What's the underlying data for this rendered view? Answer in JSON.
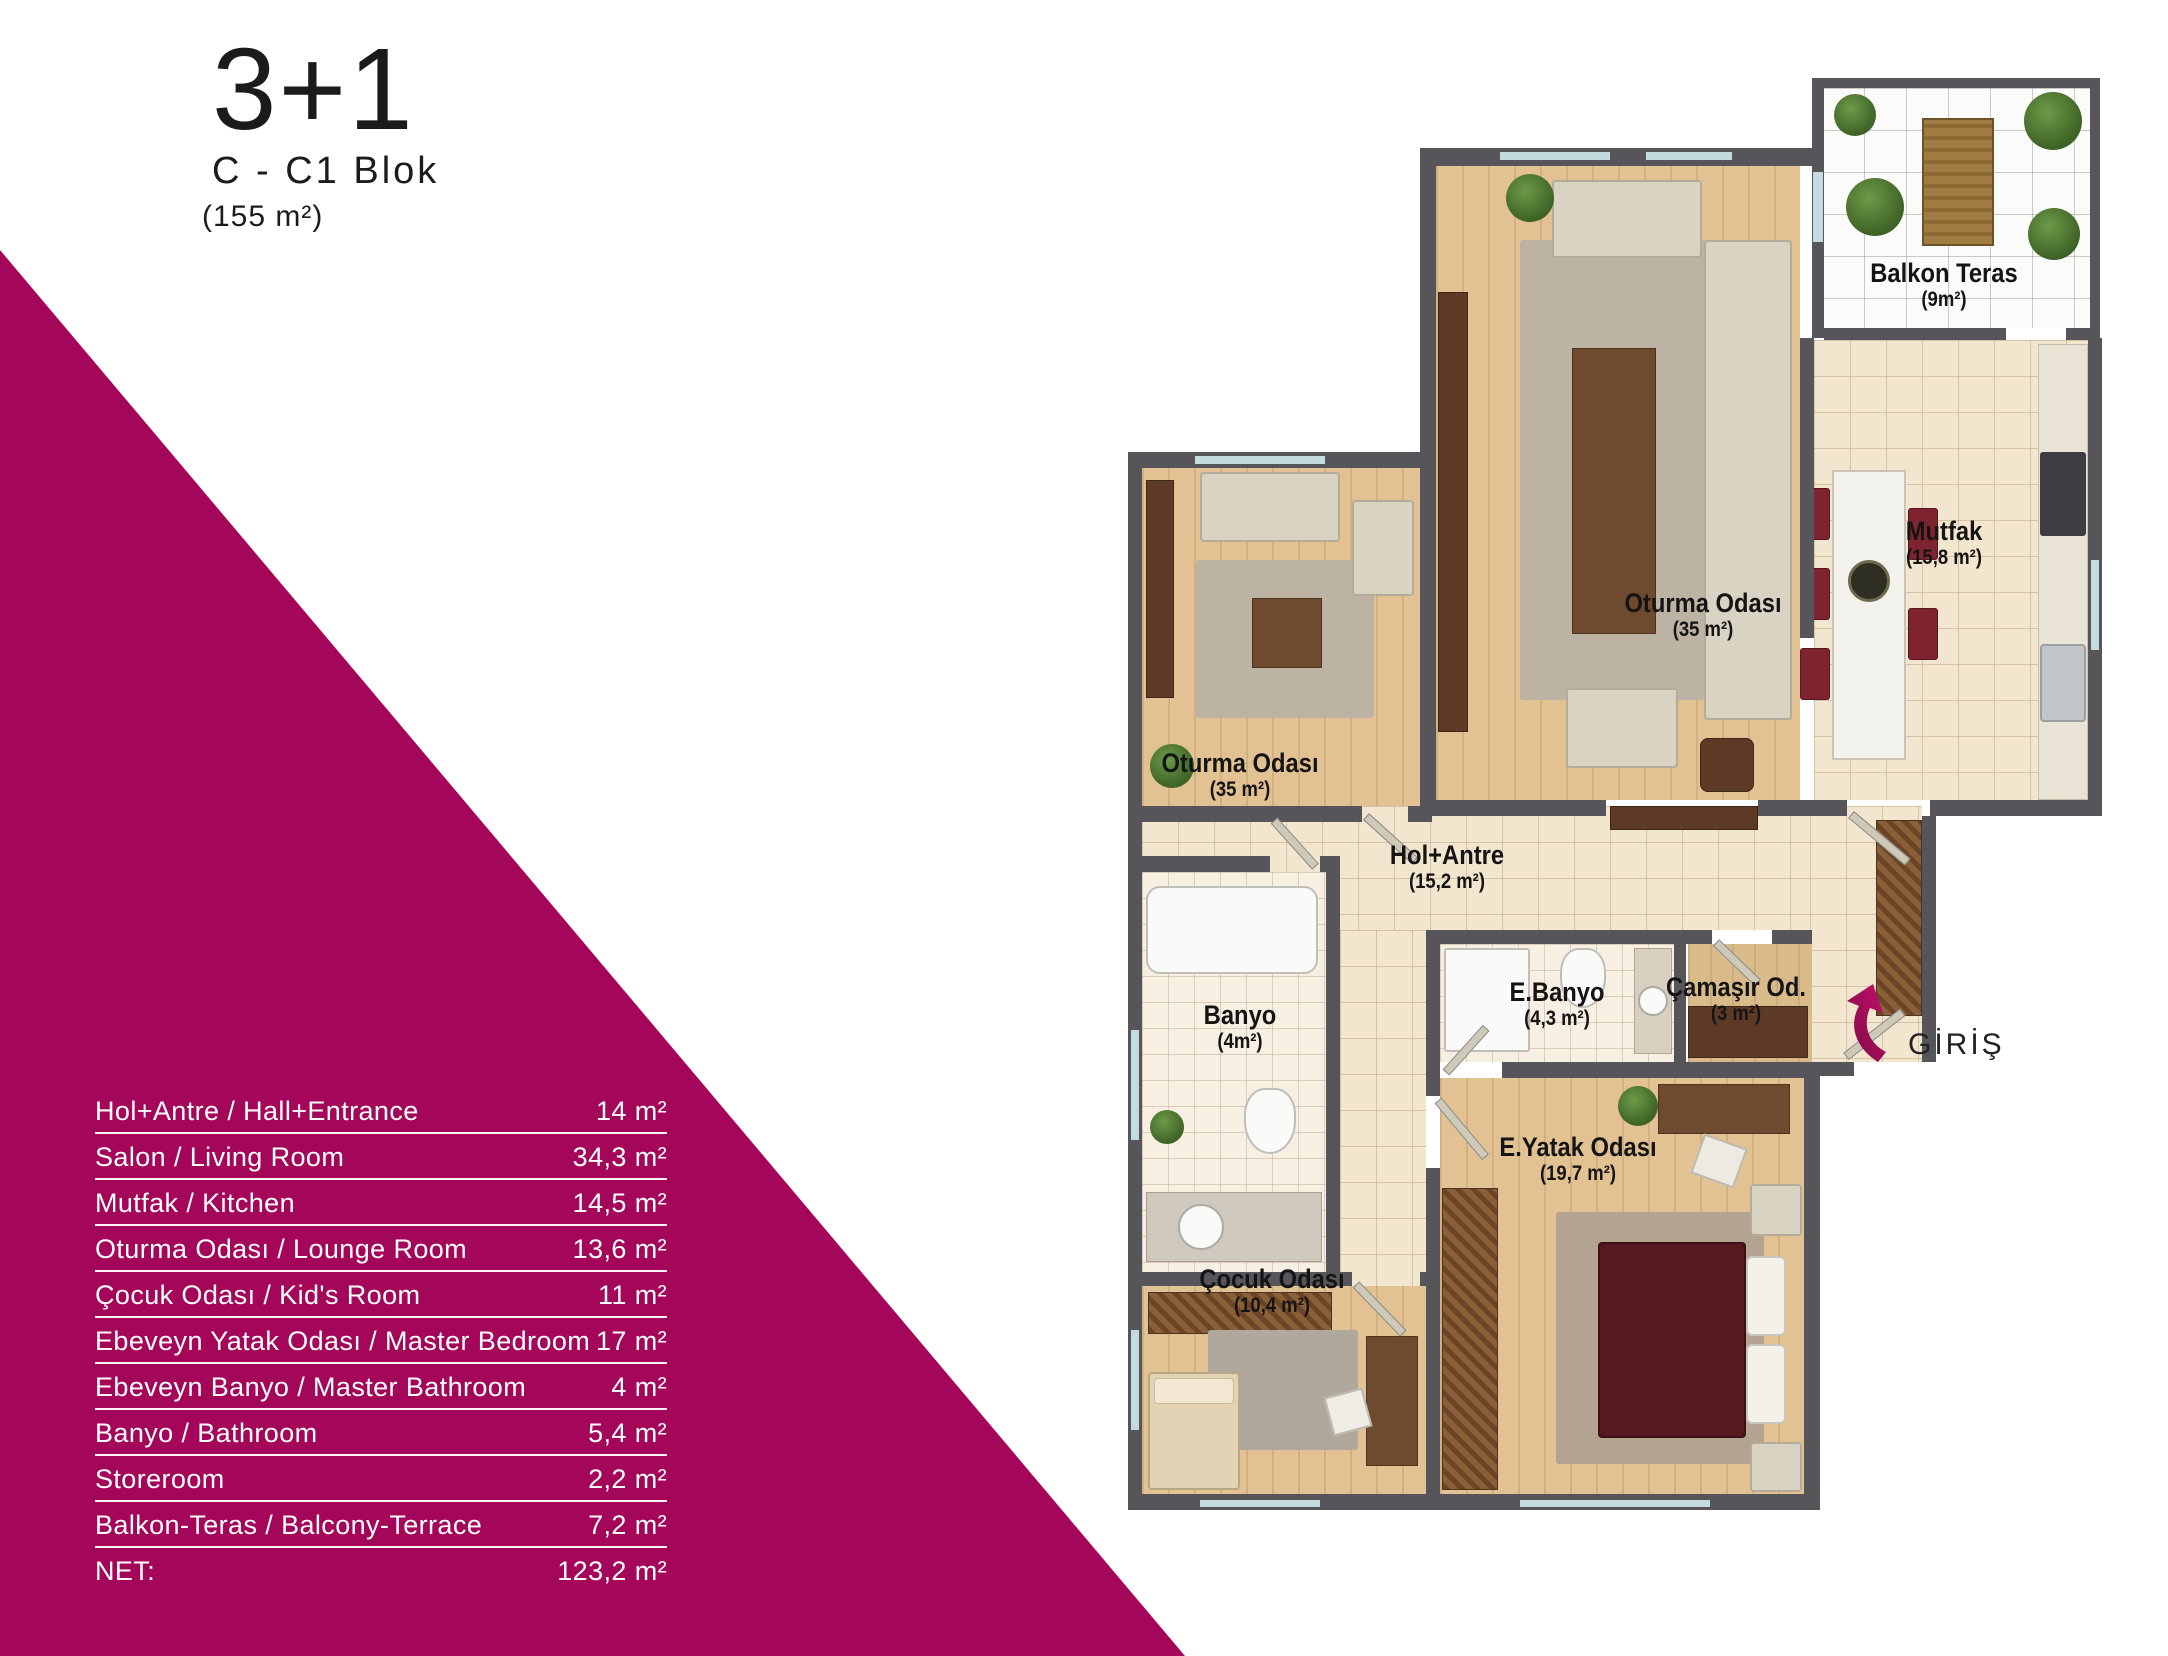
{
  "title": {
    "main": "3+1",
    "block": "C - C1 Blok",
    "area": "(155 m²)"
  },
  "colors": {
    "accent": "#A40659",
    "wall": "#56565A",
    "wood": "#E2C292",
    "tile": "#F3E6CE",
    "bed": "#58191E"
  },
  "area_table": {
    "rows": [
      {
        "label": "Hol+Antre / Hall+Entrance",
        "value": "14 m²"
      },
      {
        "label": "Salon / Living Room",
        "value": "34,3 m²"
      },
      {
        "label": "Mutfak / Kitchen",
        "value": "14,5 m²"
      },
      {
        "label": "Oturma Odası / Lounge Room",
        "value": "13,6 m²"
      },
      {
        "label": "Çocuk Odası / Kid's Room",
        "value": "11 m²"
      },
      {
        "label": "Ebeveyn Yatak Odası / Master Bedroom",
        "value": "17 m²"
      },
      {
        "label": "Ebeveyn Banyo / Master Bathroom",
        "value": "4 m²"
      },
      {
        "label": "Banyo / Bathroom",
        "value": "5,4 m²"
      },
      {
        "label": "Storeroom",
        "value": "2,2 m²"
      },
      {
        "label": "Balkon-Teras / Balcony-Terrace",
        "value": "7,2 m²"
      },
      {
        "label": "NET:",
        "value": "123,2 m²"
      }
    ]
  },
  "plan": {
    "labels": {
      "balkon": {
        "name": "Balkon Teras",
        "area": "(9m²)"
      },
      "mutfak": {
        "name": "Mutfak",
        "area": "(15,8 m²)"
      },
      "salon": {
        "name": "Oturma Odası",
        "area": "(35 m²)"
      },
      "lounge": {
        "name": "Oturma Odası",
        "area": "(35 m²)"
      },
      "hol": {
        "name": "Hol+Antre",
        "area": "(15,2 m²)"
      },
      "banyo": {
        "name": "Banyo",
        "area": "(4m²)"
      },
      "ebanyo": {
        "name": "E.Banyo",
        "area": "(4,3 m²)"
      },
      "camasir": {
        "name": "Çamaşır Od.",
        "area": "(3 m²)"
      },
      "eyatak": {
        "name": "E.Yatak Odası",
        "area": "(19,7 m²)"
      },
      "cocuk": {
        "name": "Çocuk Odası",
        "area": "(10,4 m²)"
      }
    },
    "entrance": {
      "label": "GİRİŞ"
    }
  }
}
